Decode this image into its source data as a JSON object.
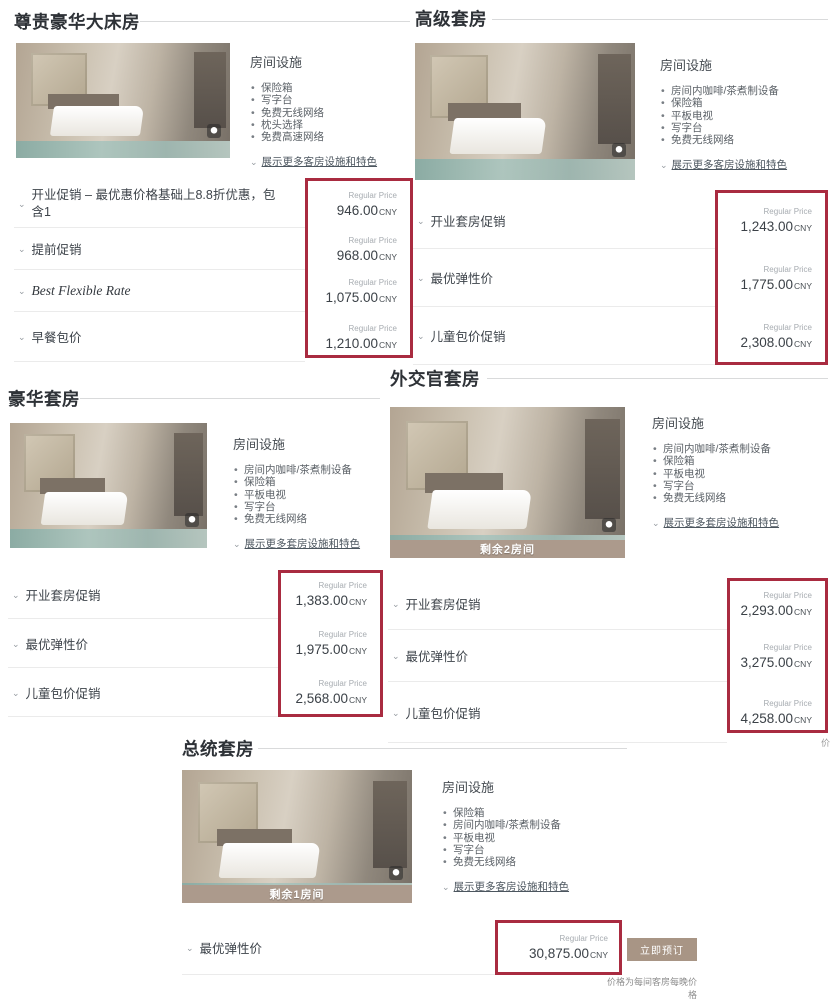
{
  "ui": {
    "regular_price_label": "Regular Price",
    "currency": "CNY",
    "amenities_header": "房间设施",
    "book_now": "立即预订",
    "price_note": "价格为每间客房每晚价格",
    "chevron": "⌄",
    "edge_fragment": "价",
    "red_accent": "#a92b40",
    "tan_accent": "#ac9a8c"
  },
  "rooms": [
    {
      "title": "尊贵豪华大床房",
      "amenities": [
        "保险箱",
        "写字台",
        "免费无线网络",
        "枕头选择",
        "免费高速网络"
      ],
      "more_link": "展示更多客房设施和特色",
      "badge": "",
      "rates": [
        {
          "name": "开业促销 – 最优惠价格基础上8.8折优惠，包含1",
          "price": "946.00"
        },
        {
          "name": "提前促销",
          "price": "968.00"
        },
        {
          "name": "Best Flexible Rate",
          "price": "1,075.00"
        },
        {
          "name": "早餐包价",
          "price": "1,210.00"
        }
      ]
    },
    {
      "title": "高级套房",
      "amenities": [
        "房间内咖啡/茶煮制设备",
        "保险箱",
        "平板电视",
        "写字台",
        "免费无线网络"
      ],
      "more_link": "展示更多客房设施和特色",
      "badge": "",
      "rates": [
        {
          "name": "开业套房促销",
          "price": "1,243.00"
        },
        {
          "name": "最优弹性价",
          "price": "1,775.00"
        },
        {
          "name": "儿童包价促销",
          "price": "2,308.00"
        }
      ]
    },
    {
      "title": "豪华套房",
      "amenities": [
        "房间内咖啡/茶煮制设备",
        "保险箱",
        "平板电视",
        "写字台",
        "免费无线网络"
      ],
      "more_link": "展示更多套房设施和特色",
      "badge": "",
      "rates": [
        {
          "name": "开业套房促销",
          "price": "1,383.00"
        },
        {
          "name": "最优弹性价",
          "price": "1,975.00"
        },
        {
          "name": "儿童包价促销",
          "price": "2,568.00"
        }
      ]
    },
    {
      "title": "外交官套房",
      "amenities": [
        "房间内咖啡/茶煮制设备",
        "保险箱",
        "平板电视",
        "写字台",
        "免费无线网络"
      ],
      "more_link": "展示更多套房设施和特色",
      "badge": "剩余2房间",
      "rates": [
        {
          "name": "开业套房促销",
          "price": "2,293.00"
        },
        {
          "name": "最优弹性价",
          "price": "3,275.00"
        },
        {
          "name": "儿童包价促销",
          "price": "4,258.00"
        }
      ]
    },
    {
      "title": "总统套房",
      "amenities": [
        "保险箱",
        "房间内咖啡/茶煮制设备",
        "平板电视",
        "写字台",
        "免费无线网络"
      ],
      "more_link": "展示更多客房设施和特色",
      "badge": "剩余1房间",
      "rates": [
        {
          "name": "最优弹性价",
          "price": "30,875.00"
        }
      ]
    }
  ]
}
